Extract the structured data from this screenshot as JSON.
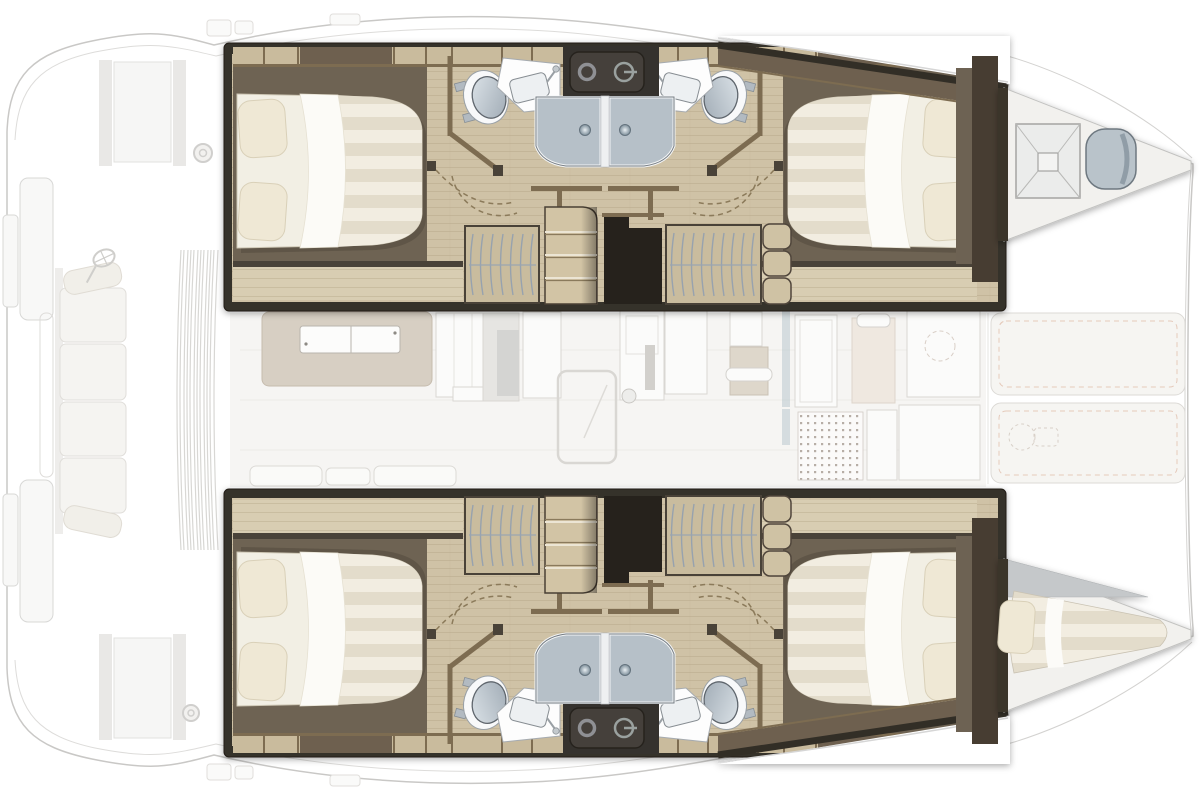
{
  "page": {
    "background": "#ffffff"
  },
  "diagram": {
    "type": "yacht-floor-plan",
    "view": "top-down",
    "vessel": "catamaran",
    "orientation": {
      "bow": "right",
      "stern": "left"
    },
    "emphasis": {
      "highlighted": "hull cabins (lower deck)",
      "faded": "main deck, saloon and cockpit"
    },
    "hulls": [
      {
        "name": "upper hull",
        "cabins": [
          {
            "name": "aft double cabin",
            "furniture": [
              "double bed",
              "two pillows",
              "hanging wardrobe",
              "shelves"
            ]
          },
          {
            "name": "forward double cabin",
            "furniture": [
              "double bed",
              "two pillows",
              "hanging wardrobe",
              "shelves"
            ]
          }
        ],
        "bathrooms": [
          {
            "name": "aft bathroom",
            "fixtures": [
              "toilet",
              "sink",
              "shower door"
            ]
          },
          {
            "name": "forward bathroom",
            "fixtures": [
              "toilet",
              "sink",
              "shower door"
            ]
          }
        ],
        "stairs": "companionway steps from saloon",
        "bow_compartment": {
          "features": [
            "deck hatch",
            "seat"
          ]
        }
      },
      {
        "name": "lower hull",
        "cabins": [
          {
            "name": "aft double cabin",
            "furniture": [
              "double bed",
              "two pillows",
              "hanging wardrobe",
              "shelves"
            ]
          },
          {
            "name": "forward double cabin",
            "furniture": [
              "double bed",
              "two pillows",
              "hanging wardrobe",
              "shelves"
            ]
          }
        ],
        "bathrooms": [
          {
            "name": "aft bathroom",
            "fixtures": [
              "toilet",
              "sink",
              "shower door"
            ]
          },
          {
            "name": "forward bathroom",
            "fixtures": [
              "toilet",
              "sink",
              "shower door"
            ]
          }
        ],
        "stairs": "companionway steps from saloon",
        "bow_compartment": {
          "features": [
            "single berth with pillow"
          ]
        }
      }
    ],
    "main_deck": {
      "aft_cockpit": [
        "bench seat with cushions",
        "helm wheel",
        "swim platform steps",
        "louvered roof"
      ],
      "saloon": [
        "sofa with table",
        "galley units",
        "sliding door with ball handle",
        "bench cushions"
      ],
      "forward_cockpit": [
        "seats",
        "dotted shower grate",
        "lockers"
      ],
      "foredeck": [
        "two stitched sunpads",
        "windlass (dashed outline)"
      ]
    }
  },
  "colors": {
    "hull_dark": "#36312a",
    "hull_void": "#26231e",
    "trim_brown": "#7d6c51",
    "trim_dark": "#4a4337",
    "floor_tan": "#cfc2a6",
    "cabinet_tan": "#c9bb9d",
    "platform_taupe": "#6e6352",
    "band_taupe": "#6e6150",
    "wardrobe_tan": "#c9bc9e",
    "hanger_line": "#97a2ae",
    "stairs_tan": "#d2c4a5",
    "bed_white": "#f2efe4",
    "pillow_cream": "#efe8d5",
    "fixture_white": "#fdfdfd",
    "shower_glass": "#b6c0c8",
    "console_dark": "#36332e",
    "seat_gray": "#b9c3ca",
    "faded_fill": "#f6f5f3",
    "faded_stroke": "#d9d7d3",
    "outline_gray": "#c9c8c6",
    "stitch_pink": "#e5cabb"
  }
}
